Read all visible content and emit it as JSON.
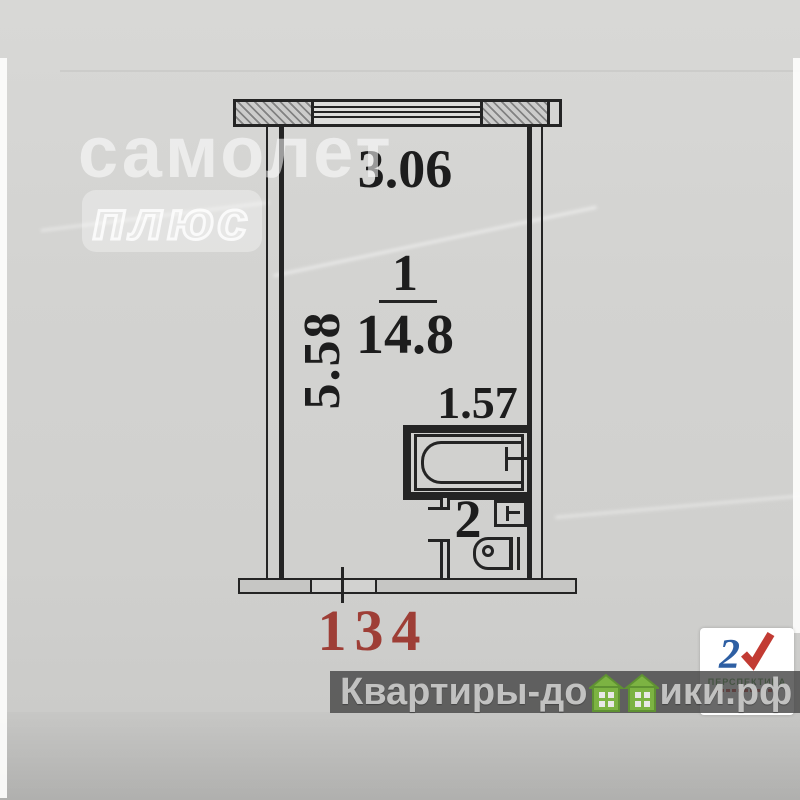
{
  "plan": {
    "dim_top": "3.06",
    "dim_left": "5.58",
    "dim_bath": "1.57",
    "room1_number": "1",
    "room1_area": "14.8",
    "room2_number": "2",
    "apartment_number": "134"
  },
  "watermark": {
    "samolet_line1": "самолет",
    "samolet_line2": "плюс"
  },
  "footer": {
    "site_prefix": "Квартиры-до",
    "site_suffix": "ики.рф"
  },
  "logo": {
    "mark": "2",
    "brand": "ПЕРСПЕКТИВА"
  },
  "colors": {
    "paper": "#d2d2d0",
    "ink": "#242424",
    "apartment_red": "#9e3e36",
    "house_green": "#7cb342",
    "band_gray": "#444444",
    "logo_blue": "#2e5fa3",
    "logo_red": "#c23b33",
    "brand_green": "#4a8f3f"
  }
}
